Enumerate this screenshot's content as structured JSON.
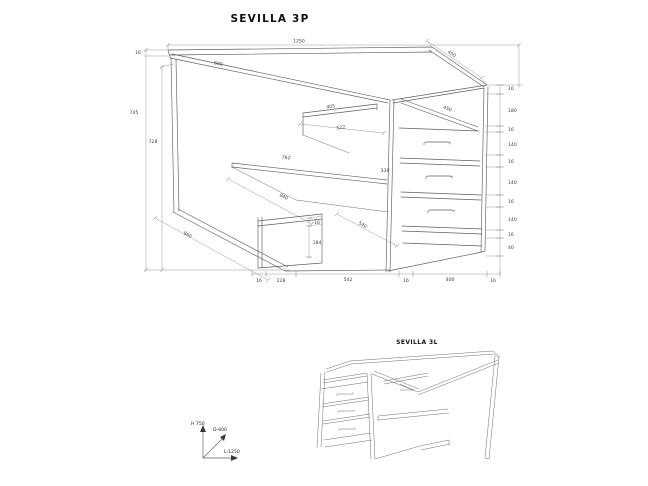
{
  "main_drawing": {
    "title": "SEVILLA 3P",
    "labels": [
      {
        "t": "1250"
      },
      {
        "t": "16"
      },
      {
        "t": "600"
      },
      {
        "t": "450"
      },
      {
        "t": "745"
      },
      {
        "t": "728"
      },
      {
        "t": "16"
      },
      {
        "t": "180"
      },
      {
        "t": "16"
      },
      {
        "t": "140"
      },
      {
        "t": "16"
      },
      {
        "t": "140"
      },
      {
        "t": "16"
      },
      {
        "t": "140"
      },
      {
        "t": "16"
      },
      {
        "t": "40"
      },
      {
        "t": "450"
      },
      {
        "t": "405"
      },
      {
        "t": "522"
      },
      {
        "t": "762"
      },
      {
        "t": "330"
      },
      {
        "t": "840"
      },
      {
        "t": "540"
      },
      {
        "t": "860"
      },
      {
        "t": "16"
      },
      {
        "t": "184"
      },
      {
        "t": "16"
      },
      {
        "t": "228"
      },
      {
        "t": "542"
      },
      {
        "t": "16"
      },
      {
        "t": "400"
      },
      {
        "t": "16"
      }
    ]
  },
  "axis_indicator": {
    "height": "H 750",
    "depth": "D-600",
    "length": "L-1250"
  },
  "secondary_drawing": {
    "title": "SEVILLA 3L"
  }
}
